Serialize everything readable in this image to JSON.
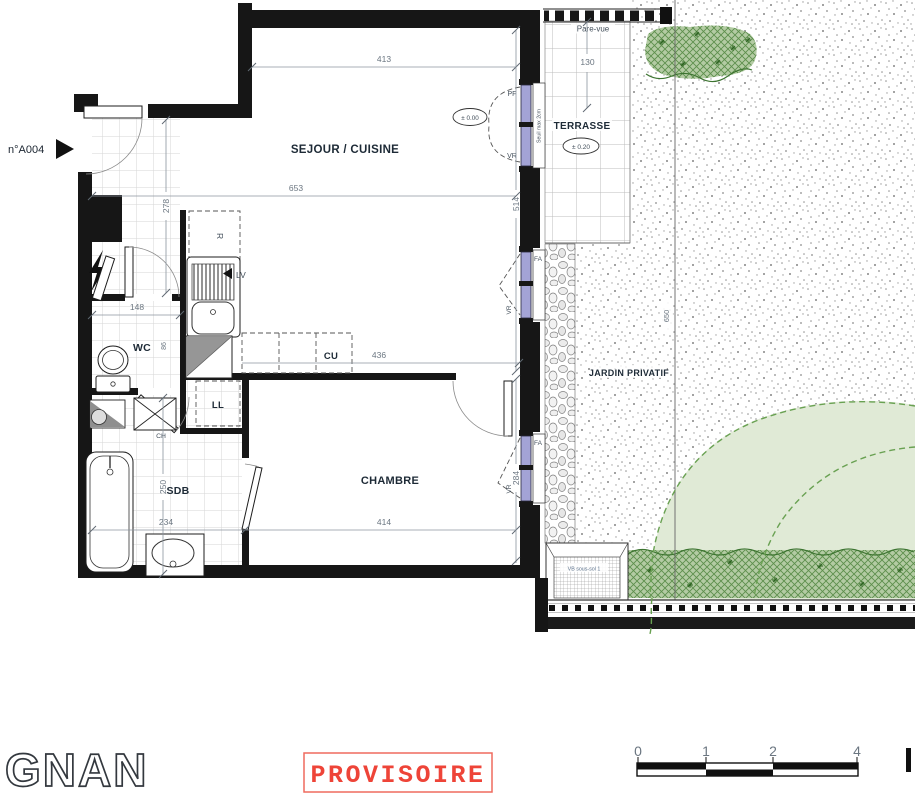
{
  "plan": {
    "unit_label": "n°A004",
    "rooms": {
      "sejour": "SEJOUR / CUISINE",
      "chambre": "CHAMBRE",
      "sdb": "SDB",
      "wc": "WC",
      "terrasse": "TERRASSE",
      "jardin": "JARDIN PRIVATIF"
    },
    "equipment": {
      "cu": "CU",
      "ll": "LL",
      "lv": "LV",
      "r": "R",
      "ch": "CH"
    },
    "openings": {
      "pf": "PF",
      "fa": "FA",
      "vr": "VR",
      "seuil_note": "Seuil max 2cm",
      "vb_note": "VB sous-sol 1",
      "pare_vue": "Pare-vue"
    },
    "levels": {
      "interior": "± 0.00",
      "terrace": "± 0.20"
    },
    "dims": {
      "d413": "413",
      "d653": "653",
      "d514": "514",
      "d278": "278",
      "d148": "148",
      "d86": "86",
      "d436": "436",
      "d414": "414",
      "d284": "284",
      "d250": "250",
      "d234": "234",
      "d130": "130",
      "d650": "650"
    },
    "colors": {
      "wall": "#161616",
      "window_glazing": "#a3a3d6",
      "hedge_green": "#5d8f4c",
      "canopy_green": "#e0ead6",
      "stamp_red": "#ee4438",
      "dim_text": "#6b7681"
    }
  },
  "footer": {
    "project_name": "GNAN",
    "stamp": "PROVISOIRE",
    "scale_labels": [
      "0",
      "1",
      "2",
      "4"
    ]
  }
}
